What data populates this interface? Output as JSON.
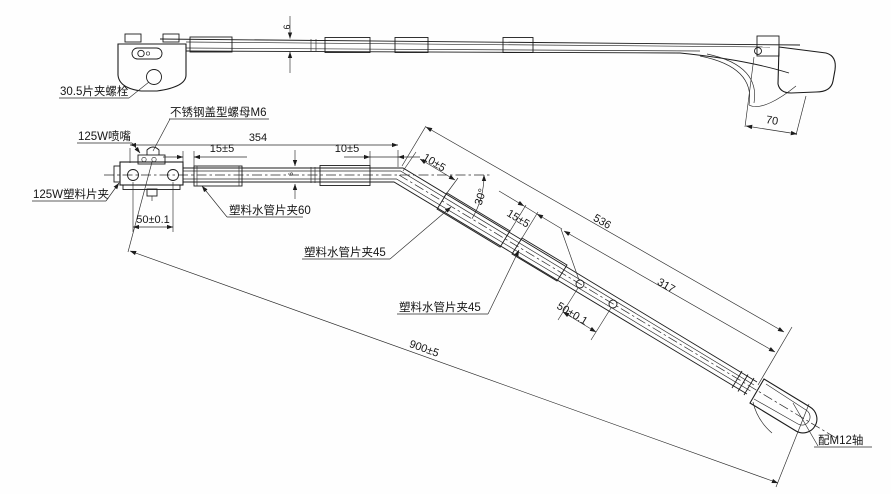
{
  "drawing": {
    "labels": {
      "clamp_bolt": "30.5片夹螺栓",
      "cap_nut": "不锈钢盖型螺母M6",
      "nozzle": "125W喷嘴",
      "plastic_clip": "125W塑料片夹",
      "hose_clip_60": "塑料水管片夹60",
      "hose_clip_45_first": "塑料水管片夹45",
      "hose_clip_45_second": "塑料水管片夹45",
      "m12_shaft": "配M12轴"
    },
    "dimensions": {
      "top_arm_height": "6",
      "top_hook_offset": "70",
      "overall_horizontal": "354",
      "gap_bracket_to_clip": "15±5",
      "gap_clip_to_bend": "10±5",
      "hole_spacing_horizontal": "50±0.1",
      "tube_height": "6",
      "gap_bend_to_clip": "10±5",
      "bend_angle": "30°",
      "gap_between_clips": "15±5",
      "slant_length_536": "536",
      "slant_length_317": "317",
      "hole_spacing_slant": "50±0.1",
      "overall_length": "900±5"
    }
  }
}
